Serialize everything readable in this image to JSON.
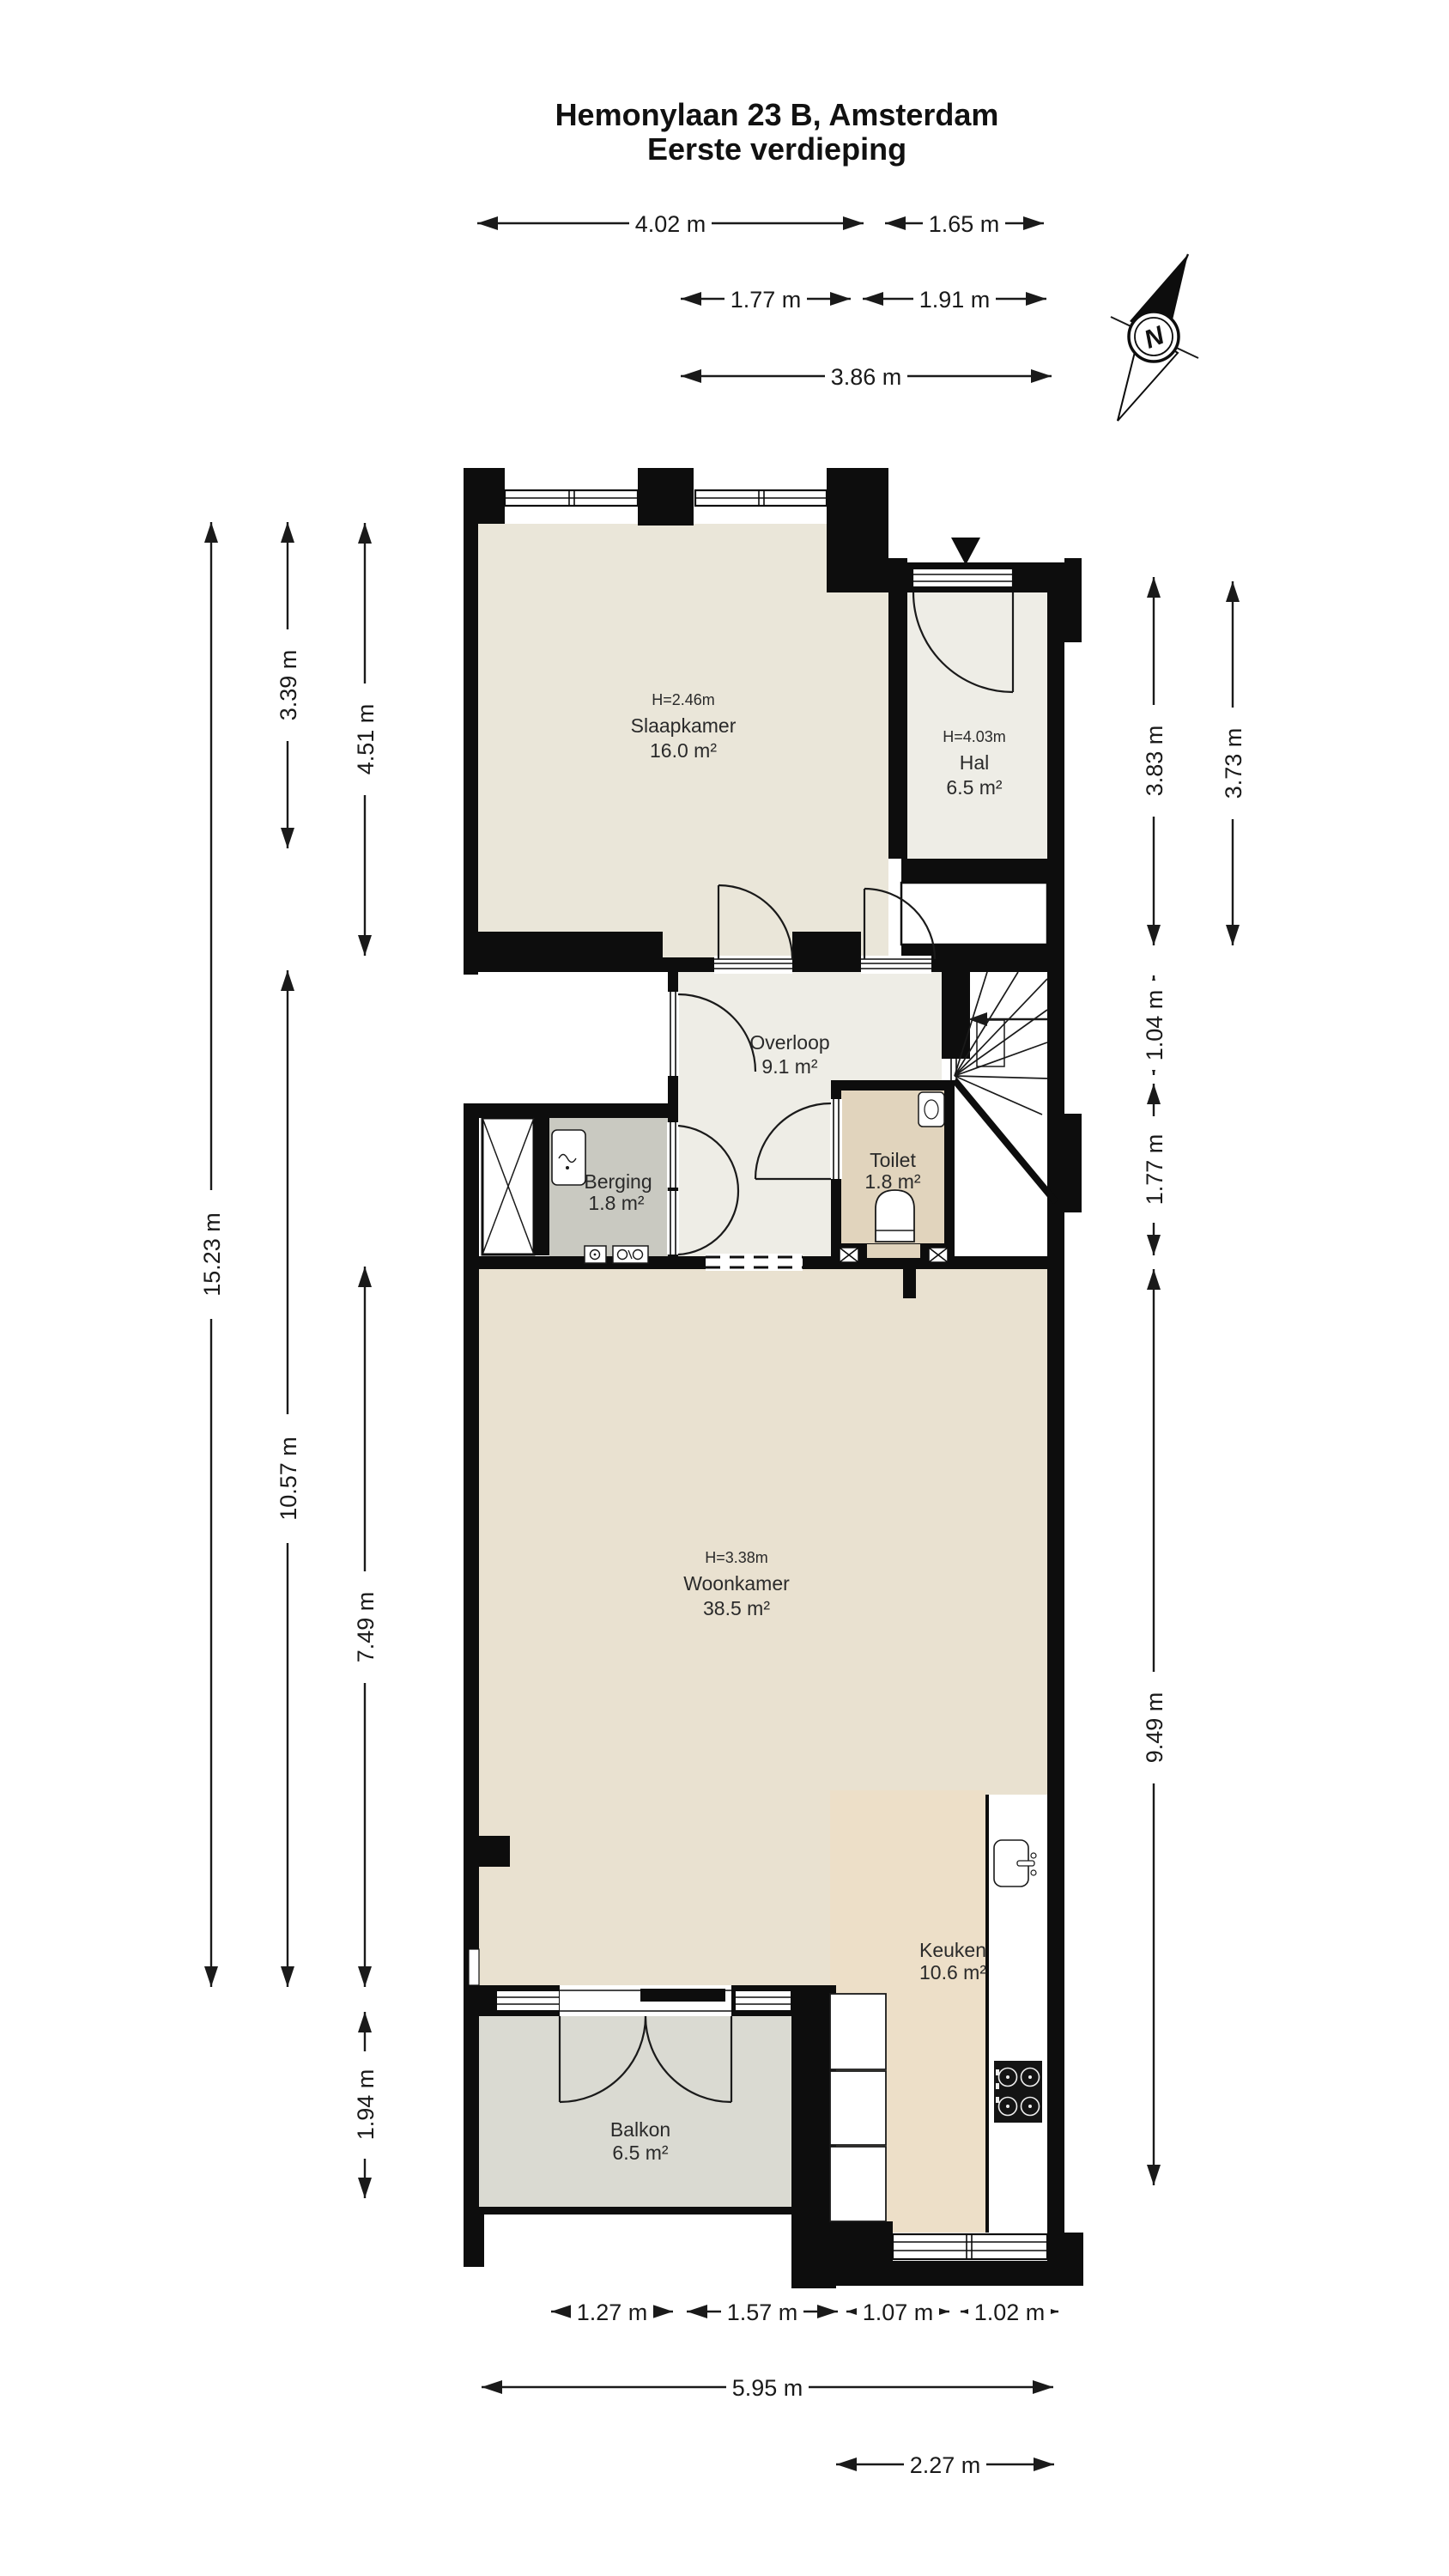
{
  "title": {
    "line1": "Hemonylaan 23 B, Amsterdam",
    "line2": "Eerste verdieping"
  },
  "compass": {
    "label": "N"
  },
  "dimensions": {
    "top": [
      {
        "label": "4.02 m"
      },
      {
        "label": "1.65 m"
      },
      {
        "label": "1.77 m"
      },
      {
        "label": "1.91 m"
      },
      {
        "label": "3.86 m"
      }
    ],
    "bottom": [
      {
        "label": "1.27 m"
      },
      {
        "label": "1.57 m"
      },
      {
        "label": "1.07 m"
      },
      {
        "label": "1.02 m"
      },
      {
        "label": "5.95 m"
      },
      {
        "label": "2.27 m"
      }
    ],
    "left": [
      {
        "label": "15.23 m"
      },
      {
        "label": "3.39 m"
      },
      {
        "label": "4.51 m"
      },
      {
        "label": "10.57 m"
      },
      {
        "label": "7.49 m"
      },
      {
        "label": "1.94 m"
      }
    ],
    "right": [
      {
        "label": "3.83 m"
      },
      {
        "label": "3.73 m"
      },
      {
        "label": "1.04 m"
      },
      {
        "label": "1.77 m"
      },
      {
        "label": "9.49 m"
      }
    ]
  },
  "rooms": {
    "slaapkamer": {
      "name": "Slaapkamer",
      "area": "16.0 m²",
      "height": "H=2.46m"
    },
    "hal": {
      "name": "Hal",
      "area": "6.5 m²",
      "height": "H=4.03m"
    },
    "overloop": {
      "name": "Overloop",
      "area": "9.1 m²"
    },
    "toilet": {
      "name": "Toilet",
      "area": "1.8 m²"
    },
    "berging": {
      "name": "Berging",
      "area": "1.8 m²"
    },
    "woonkamer": {
      "name": "Woonkamer",
      "area": "38.5 m²",
      "height": "H=3.38m"
    },
    "keuken": {
      "name": "Keuken",
      "area": "10.6 m²"
    },
    "balkon": {
      "name": "Balkon",
      "area": "6.5 m²"
    }
  },
  "colors": {
    "wall": "#0d0d0d",
    "slaapkamer": "#eae6d9",
    "hal": "#eeede6",
    "overloop": "#eeede6",
    "toilet": "#e1d4bd",
    "berging": "#c9c9c1",
    "woonkamer": "#e9e1d0",
    "keuken": "#eddfc8",
    "balkon": "#dadad2"
  }
}
